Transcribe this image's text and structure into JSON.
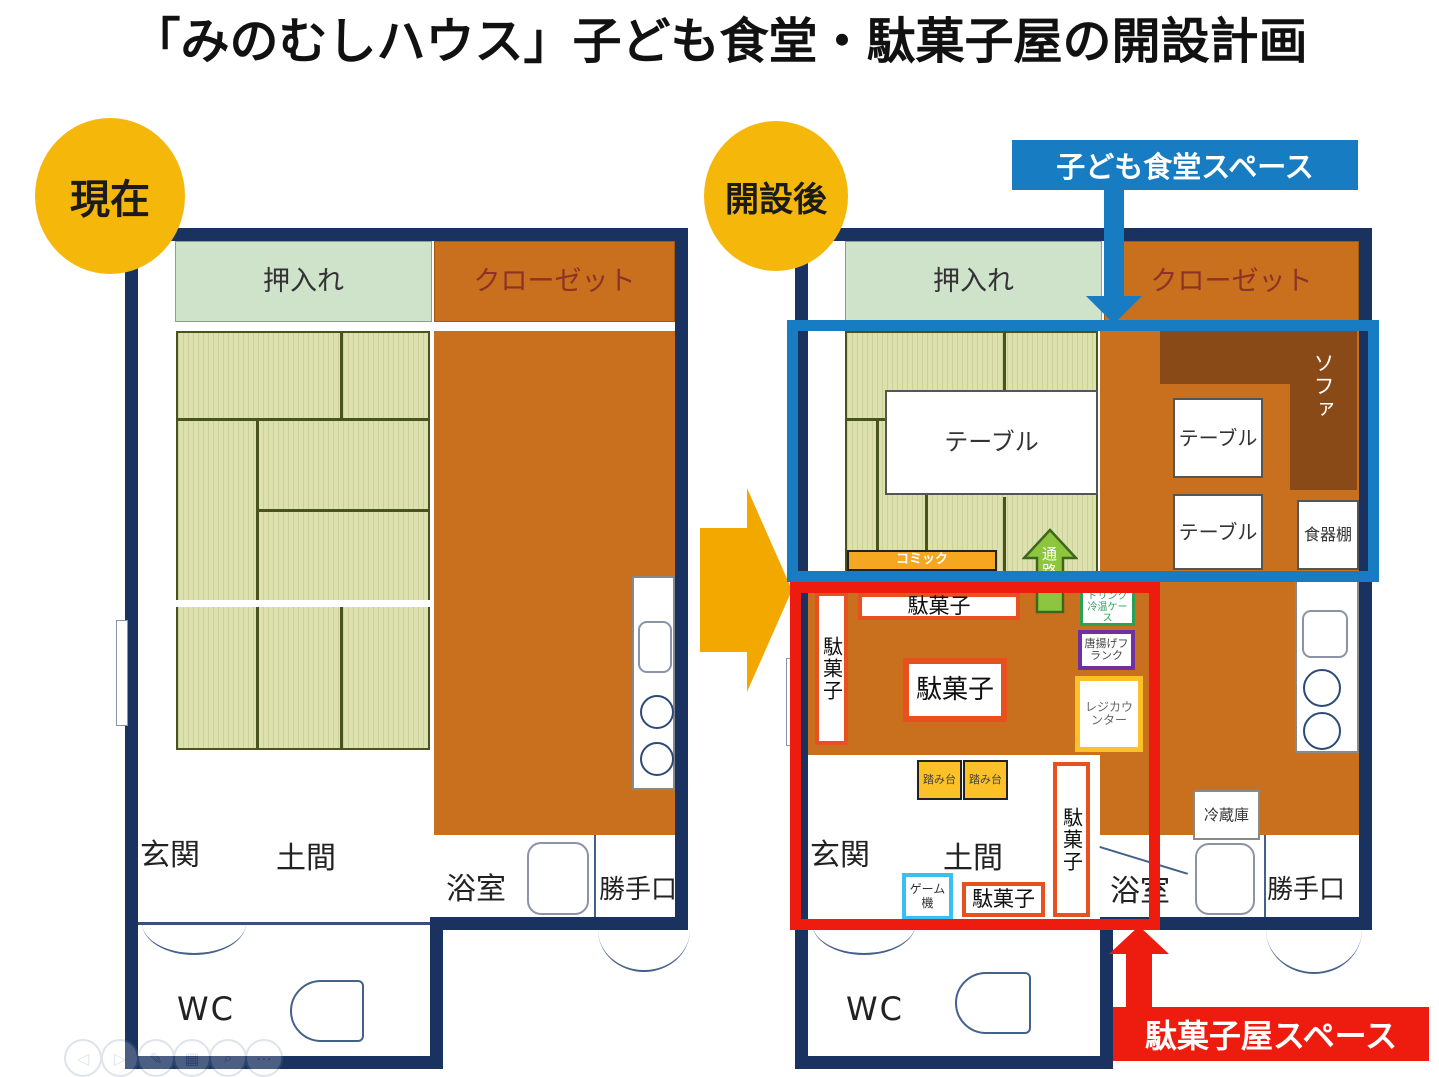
{
  "page": {
    "title": "「みのむしハウス」子ども食堂・駄菓子屋の開設計画"
  },
  "badges": {
    "current": "現在",
    "after": "開設後"
  },
  "overlays": {
    "dining_space": "子ども食堂スペース",
    "candy_space": "駄菓子屋スペース"
  },
  "rooms": {
    "oshiire": "押入れ",
    "closet": "クローゼット",
    "genkan": "玄関",
    "doma": "土間",
    "bath": "浴室",
    "backdoor": "勝手口",
    "wc": "WC"
  },
  "items": {
    "table": "テーブル",
    "sofa": "ソファ",
    "dish_shelf": "食器棚",
    "comic": "コミック",
    "passage": "通路",
    "dagashi": "駄菓子",
    "drink_case": "ドリンク冷温ケース",
    "fried_frank": "唐揚げフランク",
    "register": "レジカウンター",
    "step_stool": "踏み台",
    "game_machine": "ゲーム機",
    "fridge": "冷蔵庫"
  },
  "colors": {
    "wall_navy": "#1a3260",
    "wood_orange": "#c8701e",
    "tatami_green": "#dde1ae",
    "oshiire_green": "#cfe3cb",
    "sofa_brown": "#8a4a18",
    "accent_blue": "#177cc2",
    "accent_red": "#ee1c0f",
    "accent_yellow": "#f6b70b",
    "shelf_border": "#e8501e",
    "comic_orange": "#f6a722",
    "register_yellow": "#fcc028",
    "game_cyan": "#3bbef0",
    "drink_green": "#2aa157",
    "frank_purple": "#7030a0",
    "passage_green": "#8cc63e"
  },
  "viewer_controls": [
    {
      "name": "previous",
      "glyph": "◁"
    },
    {
      "name": "next",
      "glyph": "▷"
    },
    {
      "name": "pen",
      "glyph": "✎"
    },
    {
      "name": "grid",
      "glyph": "▦"
    },
    {
      "name": "zoom",
      "glyph": "⌕"
    },
    {
      "name": "more",
      "glyph": "⋯"
    }
  ]
}
